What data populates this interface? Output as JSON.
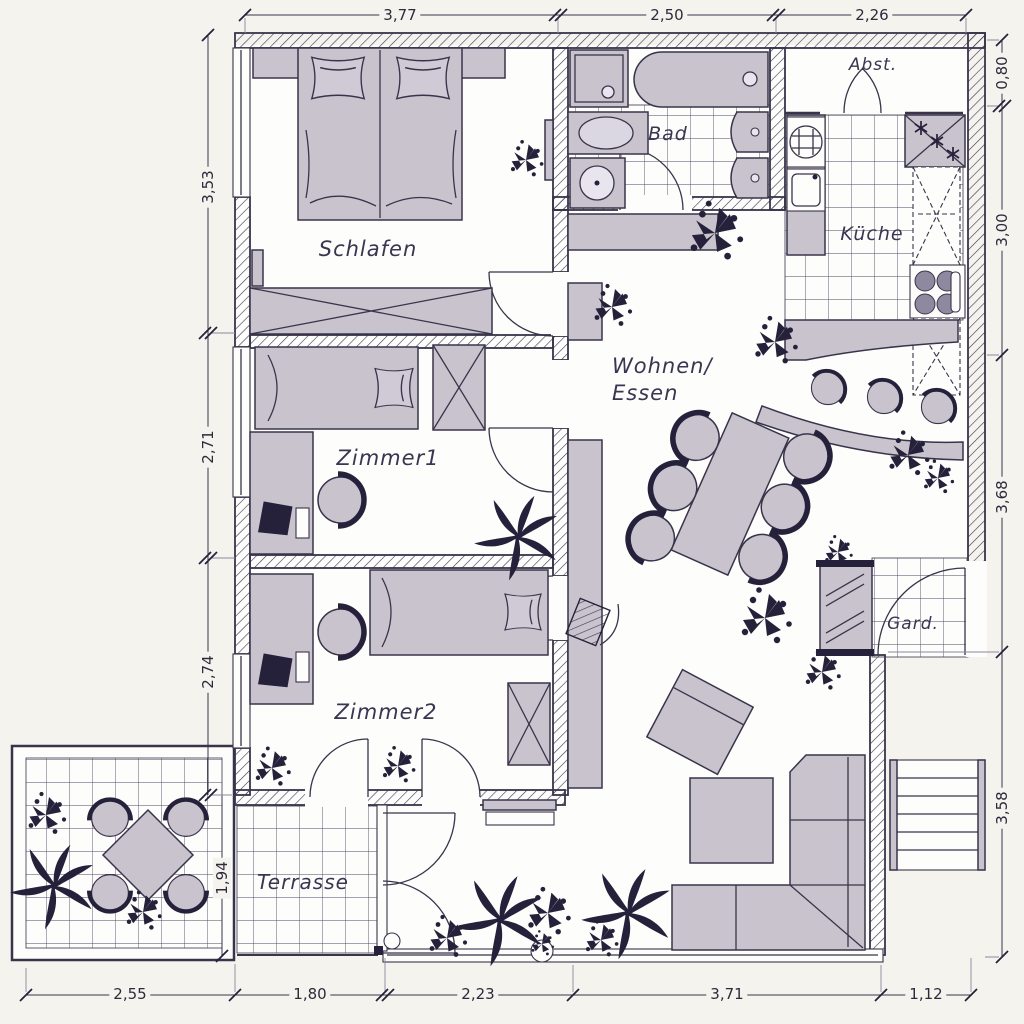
{
  "drawing": {
    "kind": "apartment floor plan",
    "language": "German"
  },
  "rooms": {
    "schlafen": {
      "label": "Schlafen"
    },
    "zimmer1": {
      "label": "Zimmer1"
    },
    "zimmer2": {
      "label": "Zimmer2"
    },
    "bad": {
      "label": "Bad"
    },
    "kueche": {
      "label": "Küche"
    },
    "abstellraum": {
      "label": "Abst."
    },
    "wohnen_essen": {
      "label_line1": "Wohnen/",
      "label_line2": "Essen"
    },
    "garderobe": {
      "label": "Gard."
    },
    "terrasse": {
      "label": "Terrasse"
    }
  },
  "dimensions": {
    "top": [
      "3,77",
      "2,50",
      "2,26"
    ],
    "left": [
      "3,53",
      "2,71",
      "2,74",
      "1,94"
    ],
    "right": [
      "0,80",
      "3,00",
      "3,68",
      "3,58"
    ],
    "bottom": [
      "2,55",
      "1,80",
      "2,23",
      "3,71",
      "1,12"
    ]
  },
  "furniture_inventory": {
    "schlafen": [
      "double-bed",
      "pillows",
      "wardrobe",
      "radiator"
    ],
    "zimmer1": [
      "single-bed",
      "wardrobe",
      "desk",
      "pc-monitor",
      "desk-chair"
    ],
    "zimmer2": [
      "single-bed",
      "wardrobe",
      "desk",
      "pc-monitor",
      "desk-chair",
      "shelf"
    ],
    "bad": [
      "shower",
      "bathtub",
      "washbasin",
      "washing-machine",
      "wc",
      "bidet"
    ],
    "kueche": [
      "hob",
      "sink",
      "freezer",
      "tall-cabinets",
      "cooktop",
      "bar-counter",
      "bar-stools"
    ],
    "wohnen_essen": [
      "dining-table",
      "dining-chairs-6",
      "corner-sofa",
      "coffee-table",
      "armchair",
      "sideboard",
      "tv",
      "plants"
    ],
    "garderobe": [
      "mirror-wardrobe",
      "entrance-door"
    ],
    "abstellraum": [
      "double-swing-door"
    ],
    "terrasse": [
      "garden-table",
      "garden-chairs-4",
      "plants"
    ]
  },
  "colors": {
    "paper": "#f4f3ee",
    "plan_floor": "#fdfdfc",
    "furniture_fill": "#c9c3ce",
    "line": "#39344a",
    "accent_dark": "#26213a"
  }
}
